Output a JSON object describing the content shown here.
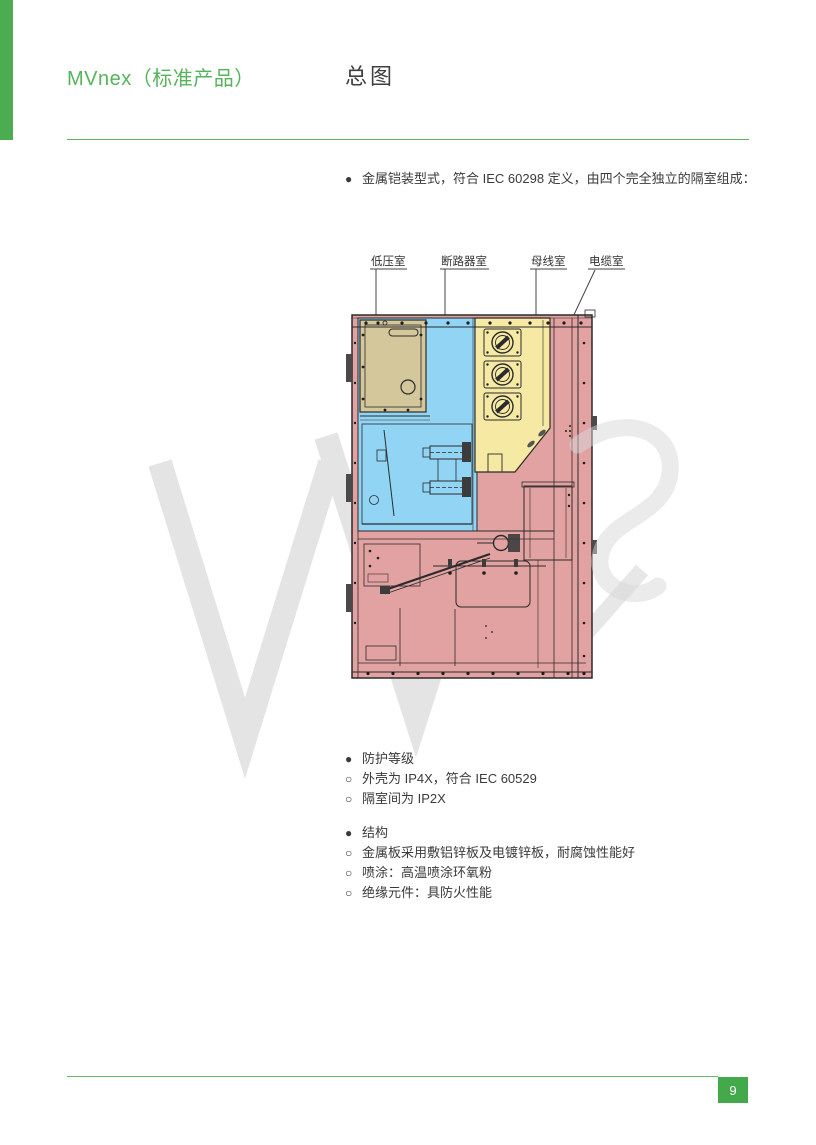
{
  "header": {
    "product_title": "MVnex（标准产品）",
    "page_title": "总图"
  },
  "intro": {
    "marker": "●",
    "text": "金属铠装型式，符合 IEC 60298 定义，由四个完全独立的隔室组成："
  },
  "diagram": {
    "labels": [
      {
        "key": "low_voltage",
        "text": "低压室"
      },
      {
        "key": "breaker",
        "text": "断路器室"
      },
      {
        "key": "busbar",
        "text": "母线室"
      },
      {
        "key": "cable",
        "text": "电缆室"
      }
    ],
    "colors": {
      "low_voltage": "#d5c79c",
      "breaker": "#92d4f4",
      "busbar": "#f6e9a4",
      "cable": "#e3a2a2",
      "outline": "#2b2b2b"
    }
  },
  "sections": [
    {
      "header": {
        "marker": "●",
        "text": "防护等级"
      },
      "items": [
        {
          "marker": "○",
          "text": "外壳为 IP4X，符合 IEC 60529"
        },
        {
          "marker": "○",
          "text": "隔室间为 IP2X"
        }
      ]
    },
    {
      "header": {
        "marker": "●",
        "text": "结构"
      },
      "items": [
        {
          "marker": "○",
          "text": "金属板采用敷铝锌板及电镀锌板，耐腐蚀性能好"
        },
        {
          "marker": "○",
          "text": "喷涂：高温喷涂环氧粉"
        },
        {
          "marker": "○",
          "text": "绝缘元件：具防火性能"
        }
      ]
    }
  ],
  "accent": {
    "green_bar": "#4bad50",
    "rule_green": "#5bb660",
    "badge_green": "#44a94a",
    "title_green": "#55b45b"
  },
  "footer": {
    "page_number": "9"
  }
}
